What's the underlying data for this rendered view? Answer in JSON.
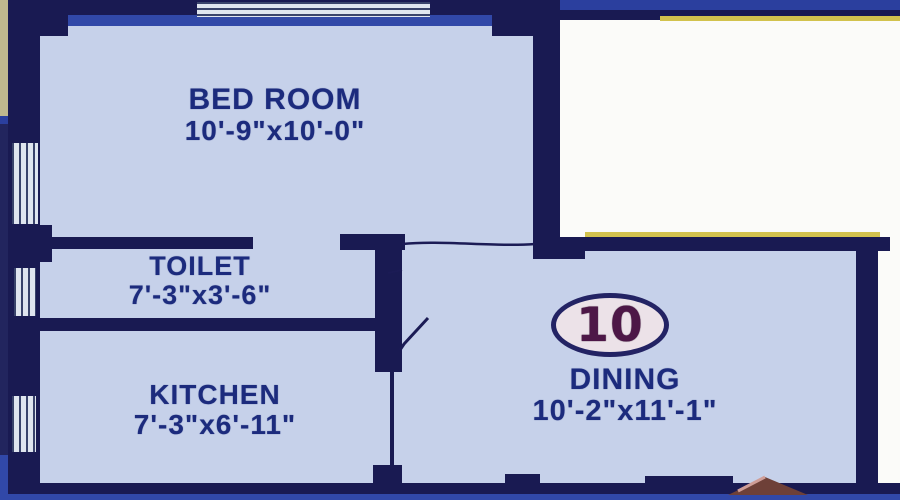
{
  "plan": {
    "unit_badge": "10",
    "rooms": [
      {
        "id": "bedroom",
        "name": "BED ROOM",
        "dims": "10'-9\"x10'-0\""
      },
      {
        "id": "toilet",
        "name": "TOILET",
        "dims": "7'-3\"x3'-6\""
      },
      {
        "id": "kitchen",
        "name": "KITCHEN",
        "dims": "7'-3\"x6'-11\""
      },
      {
        "id": "dining",
        "name": "DINING",
        "dims": "10'-2\"x11'-1\""
      }
    ],
    "colors": {
      "wall_navy": "#191a52",
      "floor_blue": "#c6d1ea",
      "border_royal_blue": "#2b3f9e",
      "masked_white": "#fbfbf9",
      "trim_yellow": "#d2c24d",
      "label_text": "#1c2b7d",
      "badge_number": "#4d1747",
      "badge_ring": "#232364",
      "top_left_tan": "#bfb88e",
      "roof_brown": "#6e4038"
    }
  }
}
